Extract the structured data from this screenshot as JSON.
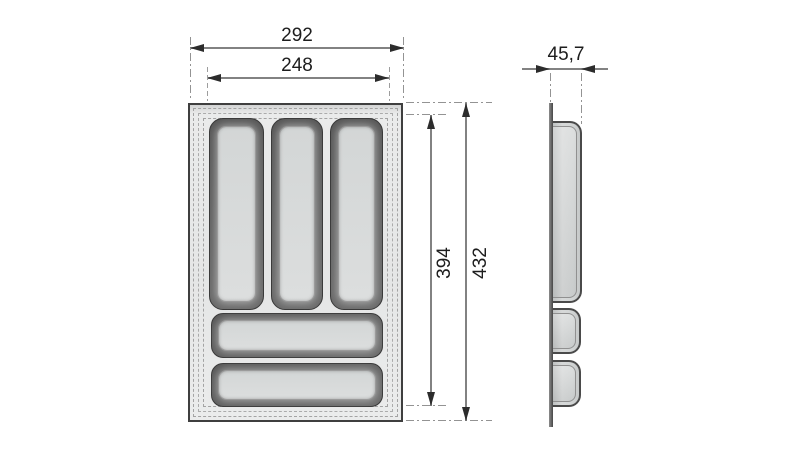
{
  "dimensions": {
    "front_outer_width": "292",
    "front_inner_width": "248",
    "front_inner_height": "394",
    "front_outer_height": "432",
    "side_depth": "45,7"
  },
  "views": {
    "front": {
      "vertical_compartments": 3,
      "horizontal_compartments": 2
    },
    "side": {
      "profile_bulges": 3
    }
  },
  "colors": {
    "background": "#ffffff",
    "outline": "#3f3f3f",
    "dimension_line": "#828282",
    "arrowhead": "#2c2c2c",
    "extension_line": "#939393",
    "tray_fill": "#e8e9e9",
    "compartment_wall": "#5f5f5f",
    "compartment_floor": "#d8dada"
  }
}
